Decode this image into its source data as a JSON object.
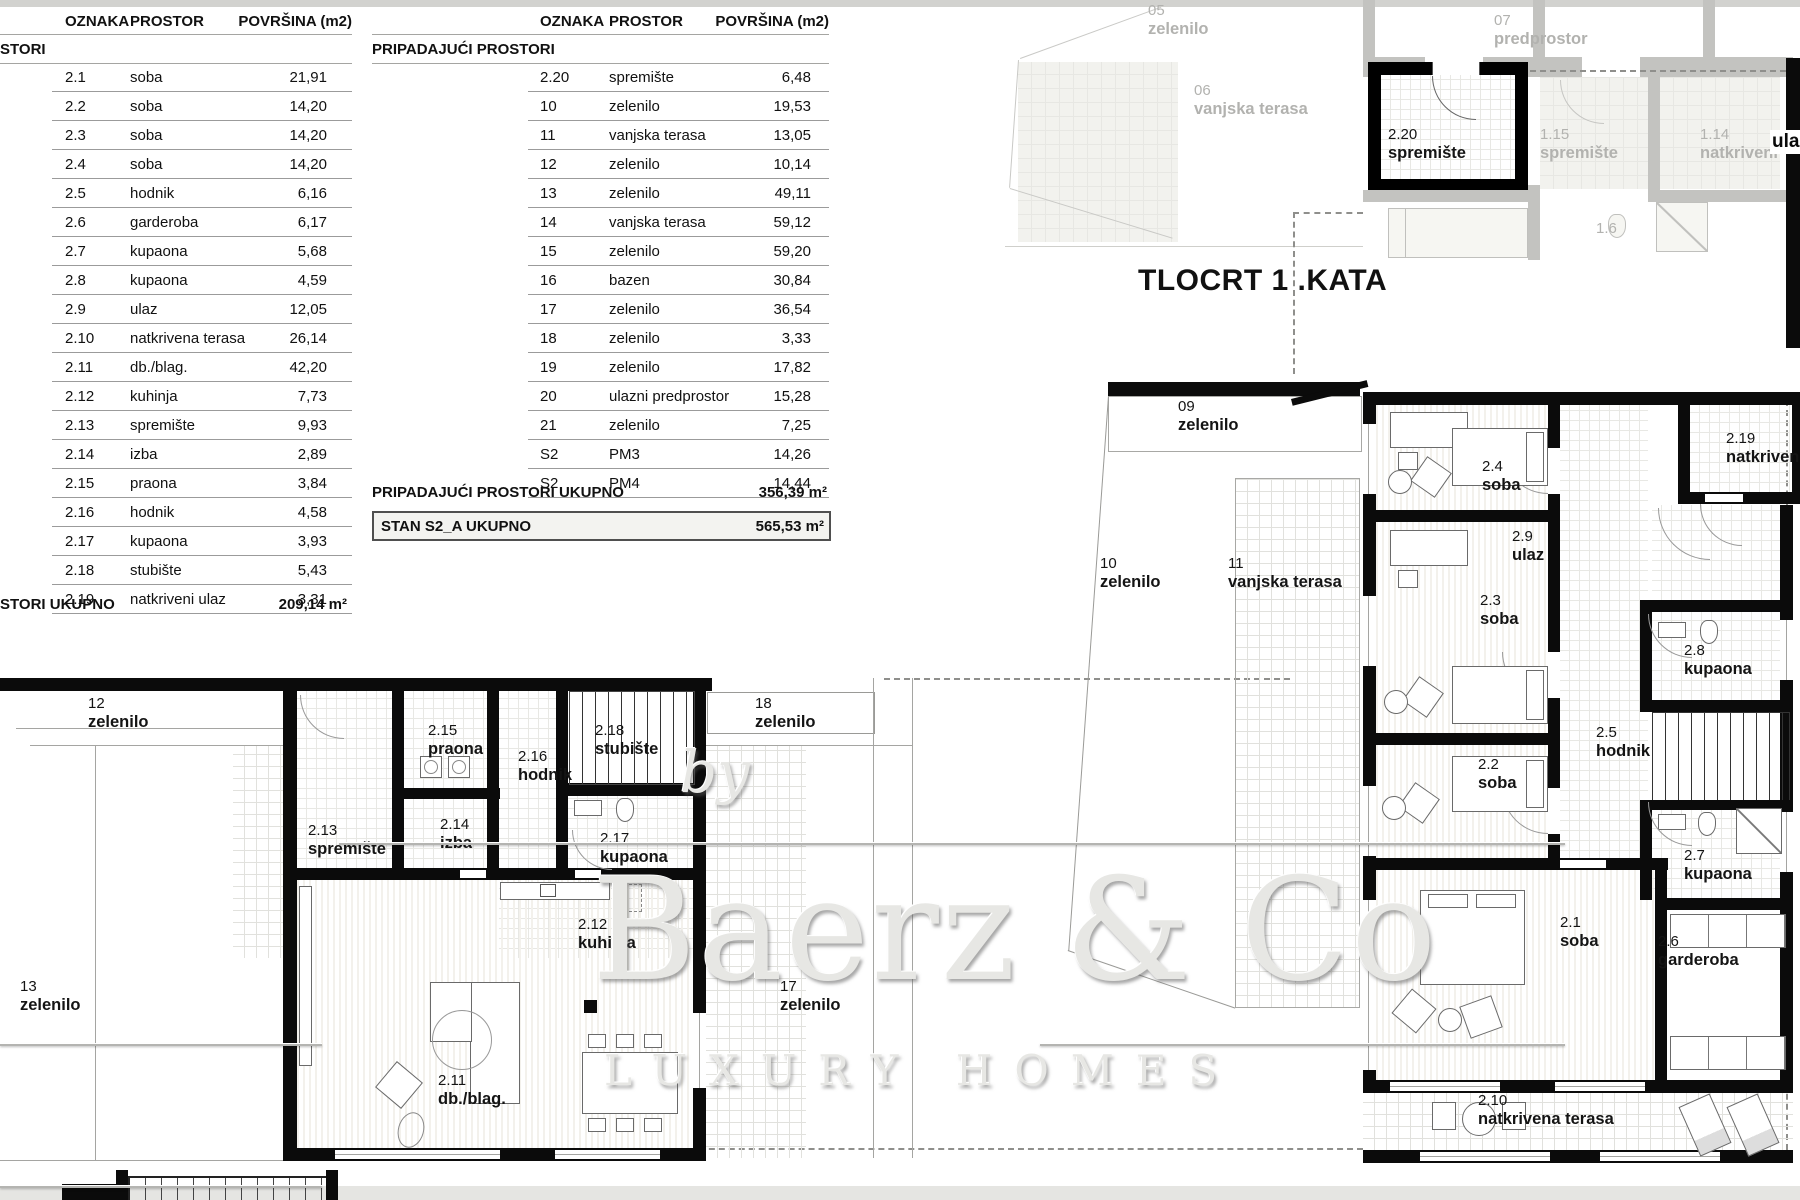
{
  "tables": {
    "col_oznaka": "OZNAKA",
    "col_prostor": "PROSTOR",
    "col_povrsina": "POVRŠINA (m2)",
    "left": {
      "section": "STORI",
      "rows": [
        {
          "code": "2.1",
          "name": "soba",
          "area": "21,91"
        },
        {
          "code": "2.2",
          "name": "soba",
          "area": "14,20"
        },
        {
          "code": "2.3",
          "name": "soba",
          "area": "14,20"
        },
        {
          "code": "2.4",
          "name": "soba",
          "area": "14,20"
        },
        {
          "code": "2.5",
          "name": "hodnik",
          "area": "6,16"
        },
        {
          "code": "2.6",
          "name": "garderoba",
          "area": "6,17"
        },
        {
          "code": "2.7",
          "name": "kupaona",
          "area": "5,68"
        },
        {
          "code": "2.8",
          "name": "kupaona",
          "area": "4,59"
        },
        {
          "code": "2.9",
          "name": "ulaz",
          "area": "12,05"
        },
        {
          "code": "2.10",
          "name": "natkrivena terasa",
          "area": "26,14"
        },
        {
          "code": "2.11",
          "name": "db./blag.",
          "area": "42,20"
        },
        {
          "code": "2.12",
          "name": "kuhinja",
          "area": "7,73"
        },
        {
          "code": "2.13",
          "name": "spremište",
          "area": "9,93"
        },
        {
          "code": "2.14",
          "name": "izba",
          "area": "2,89"
        },
        {
          "code": "2.15",
          "name": "praona",
          "area": "3,84"
        },
        {
          "code": "2.16",
          "name": "hodnik",
          "area": "4,58"
        },
        {
          "code": "2.17",
          "name": "kupaona",
          "area": "3,93"
        },
        {
          "code": "2.18",
          "name": "stubište",
          "area": "5,43"
        },
        {
          "code": "2.19",
          "name": "natkriveni ulaz",
          "area": "3,31"
        }
      ],
      "total_label": "STORI UKUPNO",
      "total_value": "209,14 m²"
    },
    "right": {
      "section": "PRIPADAJUĆI PROSTORI",
      "rows": [
        {
          "code": "2.20",
          "name": "spremište",
          "area": "6,48"
        },
        {
          "code": "10",
          "name": "zelenilo",
          "area": "19,53"
        },
        {
          "code": "11",
          "name": "vanjska terasa",
          "area": "13,05"
        },
        {
          "code": "12",
          "name": "zelenilo",
          "area": "10,14"
        },
        {
          "code": "13",
          "name": "zelenilo",
          "area": "49,11"
        },
        {
          "code": "14",
          "name": "vanjska terasa",
          "area": "59,12"
        },
        {
          "code": "15",
          "name": "zelenilo",
          "area": "59,20"
        },
        {
          "code": "16",
          "name": "bazen",
          "area": "30,84"
        },
        {
          "code": "17",
          "name": "zelenilo",
          "area": "36,54"
        },
        {
          "code": "18",
          "name": "zelenilo",
          "area": "3,33"
        },
        {
          "code": "19",
          "name": "zelenilo",
          "area": "17,82"
        },
        {
          "code": "20",
          "name": "ulazni predprostor",
          "area": "15,28"
        },
        {
          "code": "21",
          "name": "zelenilo",
          "area": "7,25"
        },
        {
          "code": "S2",
          "name": "PM3",
          "area": "14,26"
        },
        {
          "code": "S2",
          "name": "PM4",
          "area": "14,44"
        }
      ],
      "total_label": "PRIPADAJUĆI PROSTORI UKUPNO",
      "total_value": "356,39 m²",
      "grand_label": "STAN S2_A UKUPNO",
      "grand_value": "565,53 m²"
    }
  },
  "plan_title": "TLOCRT 1 .KATA",
  "upper_fragment_labels": [
    {
      "code": "05",
      "name": "zelenilo"
    },
    {
      "code": "07",
      "name": "predprostor"
    },
    {
      "code": "06",
      "name": "vanjska terasa"
    },
    {
      "code": "2.20",
      "name": "spremište"
    },
    {
      "code": "1.15",
      "name": "spremište"
    },
    {
      "code": "1.14",
      "name": "natkriveni"
    },
    {
      "code": "1.6",
      "name": ""
    },
    {
      "code": "",
      "name": "ula"
    }
  ],
  "right_plan_labels": [
    {
      "code": "09",
      "name": "zelenilo"
    },
    {
      "code": "10",
      "name": "zelenilo"
    },
    {
      "code": "11",
      "name": "vanjska terasa"
    },
    {
      "code": "2.4",
      "name": "soba"
    },
    {
      "code": "2.19",
      "name": "natkriven"
    },
    {
      "code": "2.9",
      "name": "ulaz"
    },
    {
      "code": "2.3",
      "name": "soba"
    },
    {
      "code": "2.8",
      "name": "kupaona"
    },
    {
      "code": "2.2",
      "name": "soba"
    },
    {
      "code": "2.5",
      "name": "hodnik"
    },
    {
      "code": "2.7",
      "name": "kupaona"
    },
    {
      "code": "2.1",
      "name": "soba"
    },
    {
      "code": "2.6",
      "name": "garderoba"
    },
    {
      "code": "2.10",
      "name": "natkrivena terasa"
    }
  ],
  "left_plan_labels": [
    {
      "code": "12",
      "name": "zelenilo"
    },
    {
      "code": "18",
      "name": "zelenilo"
    },
    {
      "code": "2.15",
      "name": "praona"
    },
    {
      "code": "2.16",
      "name": "hodnik"
    },
    {
      "code": "2.18",
      "name": "stubište"
    },
    {
      "code": "2.13",
      "name": "spremište"
    },
    {
      "code": "2.14",
      "name": "izba"
    },
    {
      "code": "2.17",
      "name": "kupaona"
    },
    {
      "code": "2.12",
      "name": "kuhinja"
    },
    {
      "code": "13",
      "name": "zelenilo"
    },
    {
      "code": "17",
      "name": "zelenilo"
    },
    {
      "code": "2.11",
      "name": "db./blag."
    }
  ],
  "watermark": {
    "by": "by",
    "name": "Baerz & Co",
    "tagline": "LUXURY HOMES"
  }
}
